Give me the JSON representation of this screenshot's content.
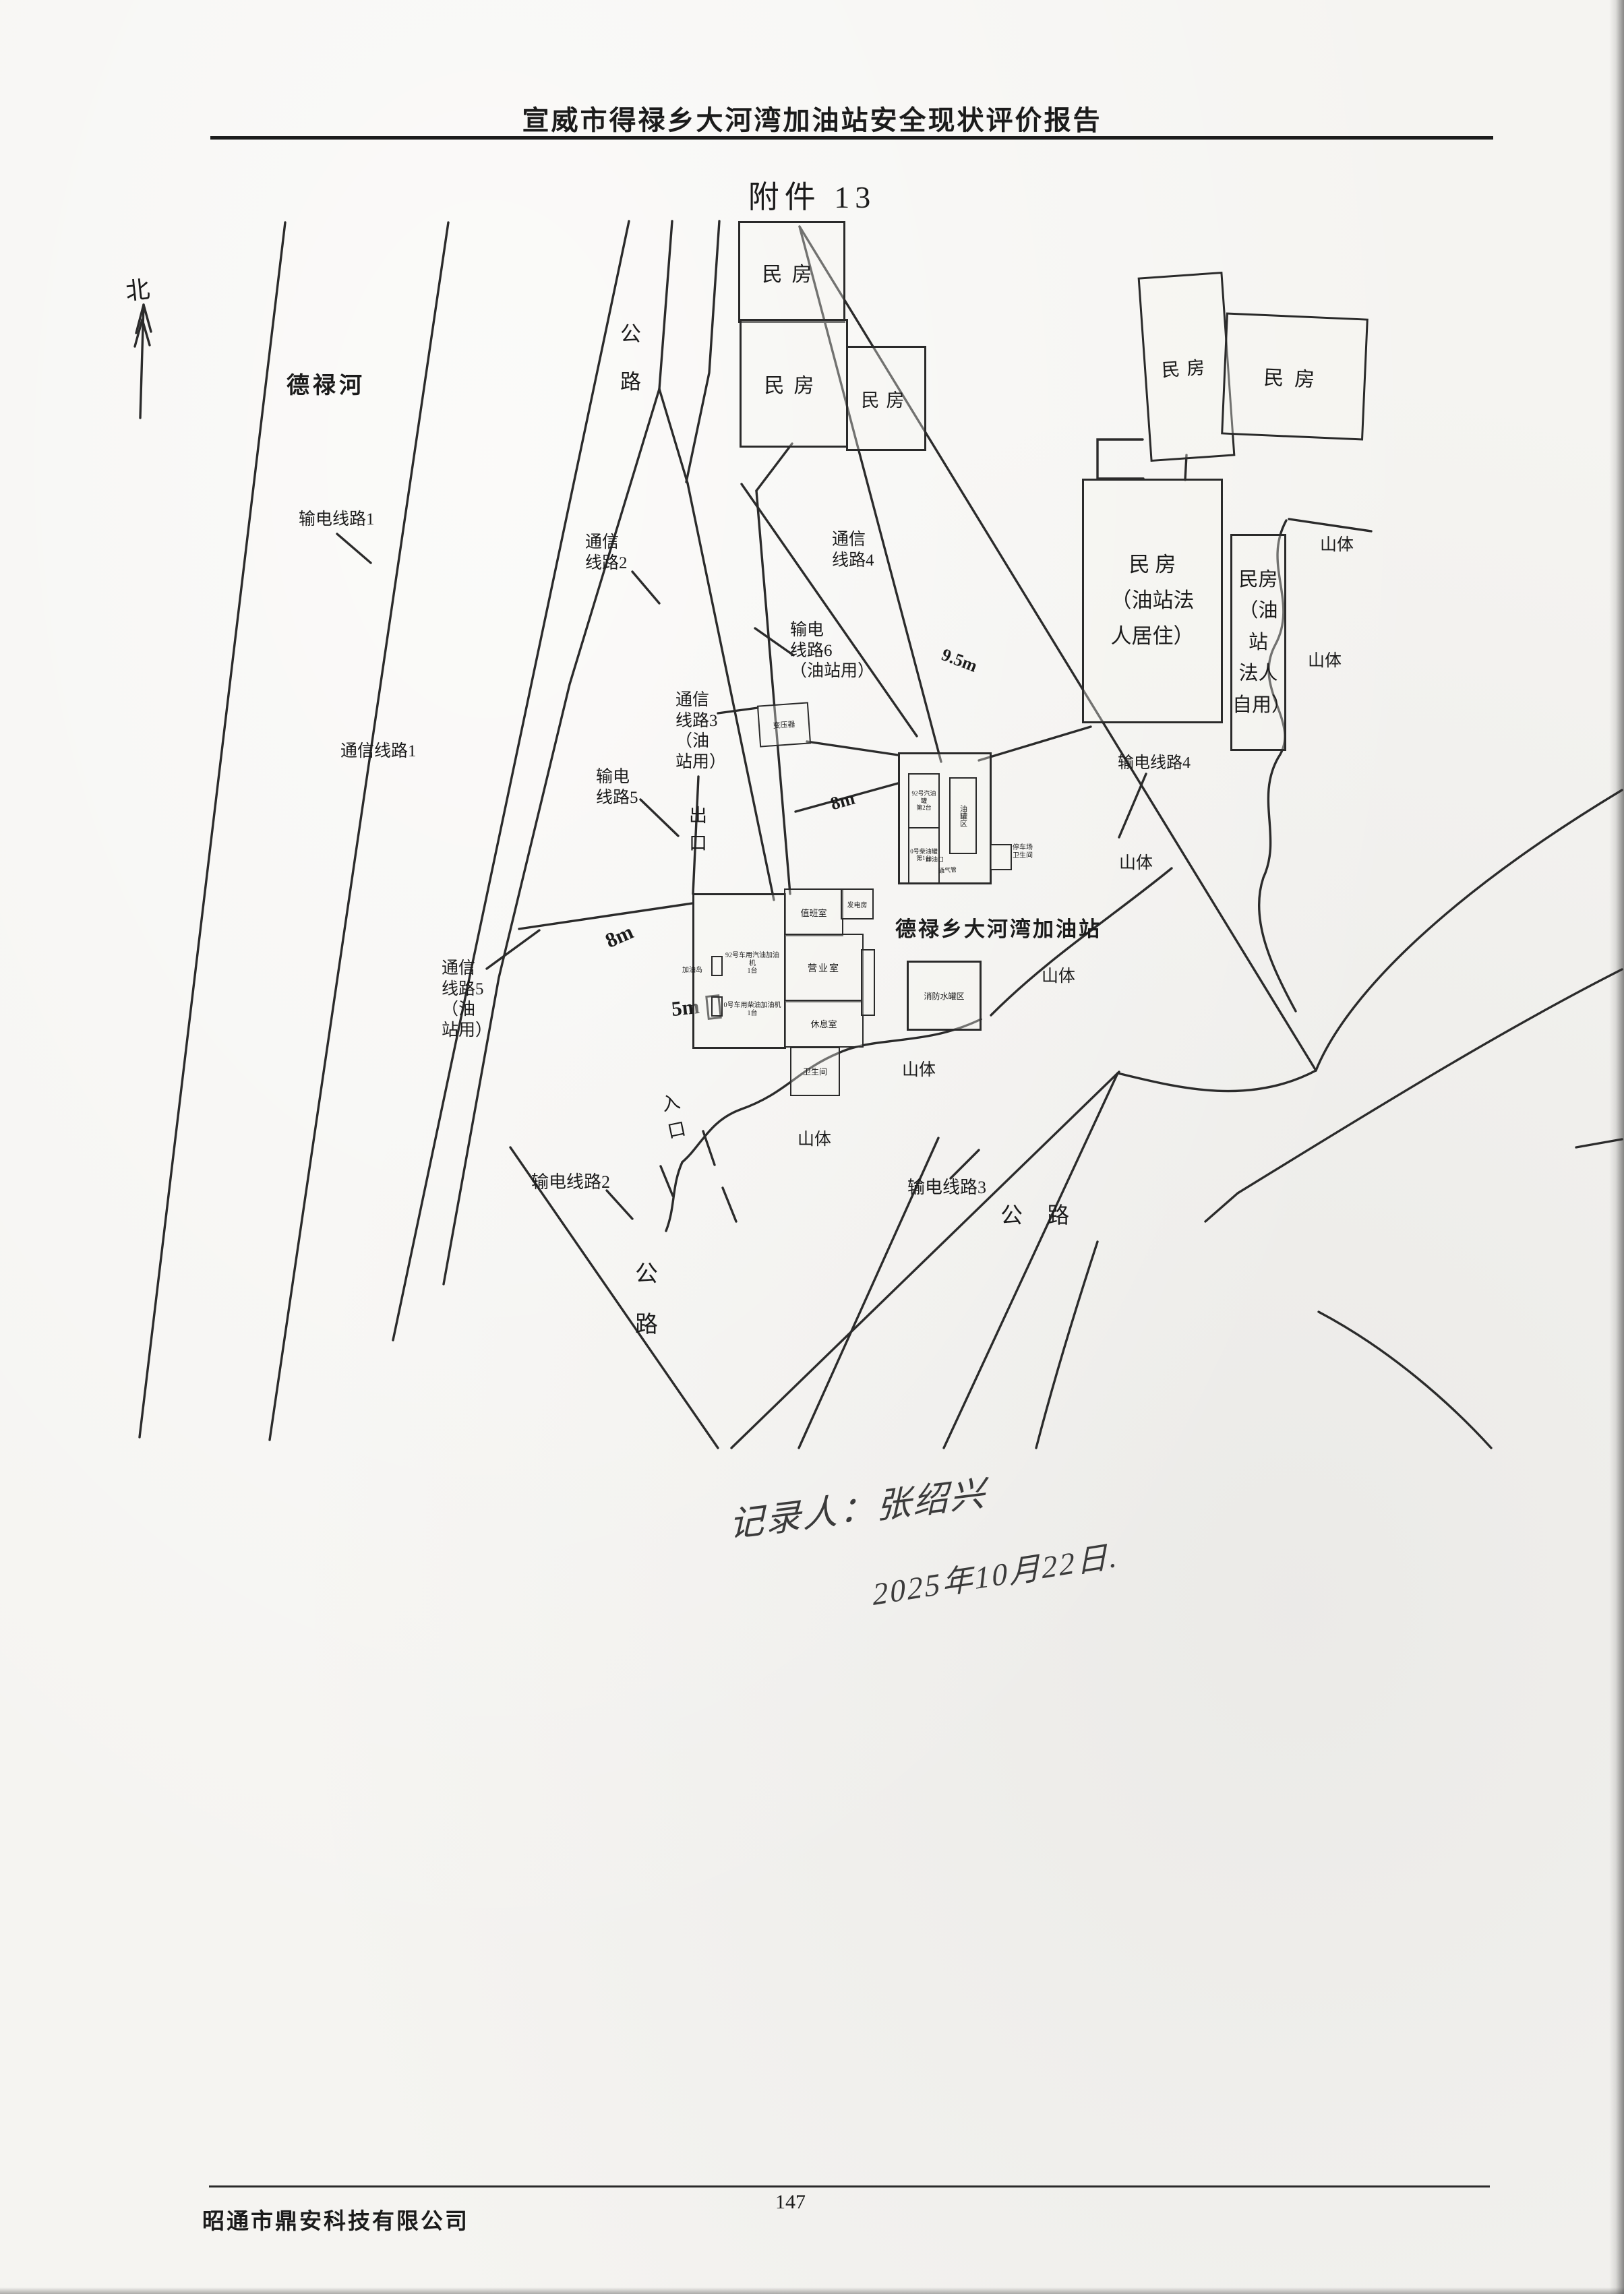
{
  "page": {
    "header_title": "宣威市得禄乡大河湾加油站安全现状评价报告",
    "attachment_title": "附件 13"
  },
  "compass": {
    "north": "北"
  },
  "map": {
    "river": "德禄河",
    "station_name": "德禄乡大河湾加油站",
    "road_top": "公\n路",
    "road_bottom": "公\n路",
    "road_right": "公 路",
    "exit": "出\n口",
    "entrance": "入\n口",
    "mountain_label": "山体",
    "power_line_1": "输电线路1",
    "power_line_2": "输电线路2",
    "power_line_3": "输电线路3",
    "power_line_4": "输电线路4",
    "power_line_5": "输电\n线路5",
    "power_line_6": "输电\n线路6\n（油站用）",
    "comm_line_1": "通信线路1",
    "comm_line_2": "通信\n线路2",
    "comm_line_3": "通信\n线路3\n（油\n站用）",
    "comm_line_4": "通信\n线路4",
    "comm_line_5": "通信\n线路5\n（油\n站用）",
    "dim_8m_top": "8m",
    "dim_8m_bottom": "8m",
    "dim_5m": "5m",
    "dim_9_5m": "9.5m"
  },
  "houses": {
    "plain": "民房",
    "owner_residence": "民 房\n（油站法\n人居住）",
    "owner_own": "民房\n（油站\n法人\n自用）"
  },
  "station": {
    "duty_room": "值班室",
    "generator_room": "发电房",
    "business_room": "营业室",
    "rest_room": "休息室",
    "toilet": "卫生间",
    "transformer": "变压器",
    "gas_tank": "92号汽油罐\n第2台",
    "diesel_tank": "0号柴油罐\n第1台",
    "tank_area": "油罐区",
    "unload_port": "卸油口",
    "vent_pipe": "通气管",
    "fire_water_area": "消防水罐区",
    "parking_toilet": "停车场\n卫生间",
    "pump_island": "加油岛",
    "gas_dispenser": "92号车用汽油加油机\n1台",
    "diesel_dispenser": "0号车用柴油加油机1台"
  },
  "handwriting": {
    "recorder": "记录人：张绍兴",
    "date": "2025年10月22日."
  },
  "footer": {
    "company": "昭通市鼎安科技有限公司",
    "page_number": "147"
  }
}
